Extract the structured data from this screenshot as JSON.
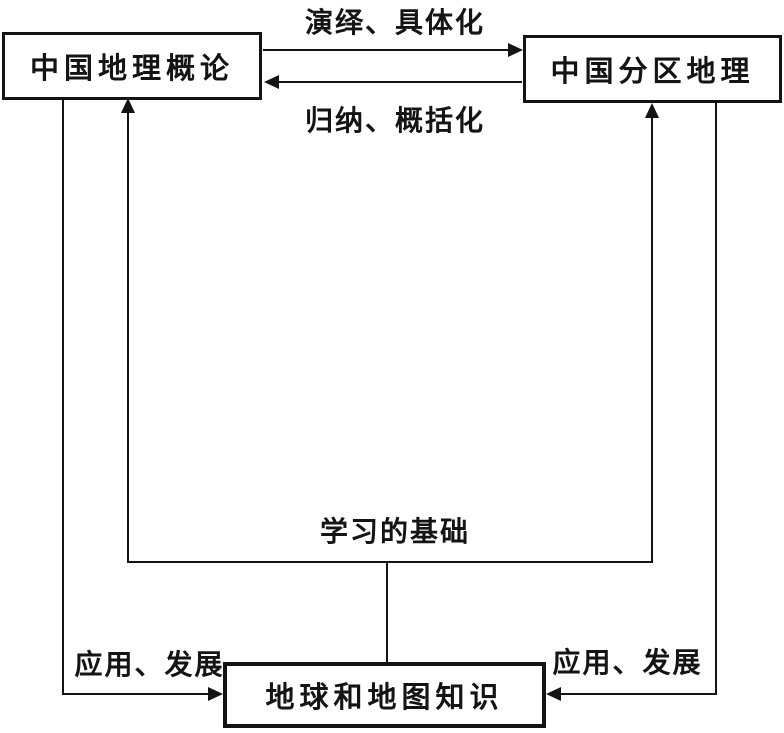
{
  "diagram": {
    "nodes": {
      "overview": "中国地理概论",
      "regional": "中国分区地理",
      "earth_map": "地球和地图知识"
    },
    "edge_labels": {
      "deduction": "演绎、具体化",
      "induction": "归纳、概括化",
      "foundation": "学习的基础",
      "apply_left": "应用、发展",
      "apply_right": "应用、发展"
    },
    "relations": [
      {
        "from": "overview",
        "to": "regional",
        "label": "演绎、具体化"
      },
      {
        "from": "regional",
        "to": "overview",
        "label": "归纳、概括化"
      },
      {
        "from": "earth_map",
        "to": "overview",
        "label": "学习的基础"
      },
      {
        "from": "earth_map",
        "to": "regional",
        "label": "学习的基础"
      },
      {
        "from": "overview",
        "to": "earth_map",
        "label": "应用、发展"
      },
      {
        "from": "regional",
        "to": "earth_map",
        "label": "应用、发展"
      }
    ],
    "colors": {
      "line": "#141414",
      "background": "#ffffff"
    }
  }
}
